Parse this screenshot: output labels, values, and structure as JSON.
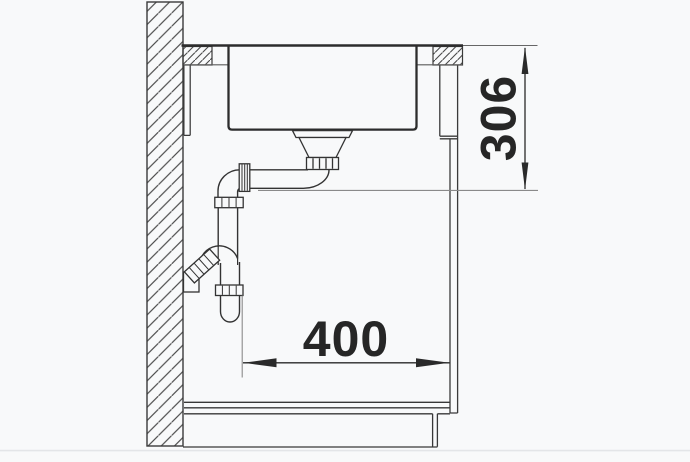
{
  "drawing": {
    "title": "sink-installation-side-section",
    "dimension_vertical": {
      "label": "306",
      "orientation": "vertical",
      "position": "right-of-cabinet"
    },
    "dimension_horizontal": {
      "label": "400",
      "orientation": "horizontal",
      "position": "below-siphon"
    },
    "colors": {
      "background": "#f8f9fa",
      "line_primary": "#2d2d2d",
      "line_secondary": "#5a5a5a",
      "extension_line": "#8a8a8a",
      "hatch_line": "#4c4c4c",
      "dimension_text": "#262626",
      "baseboard_line": "#e3e5e8"
    }
  }
}
